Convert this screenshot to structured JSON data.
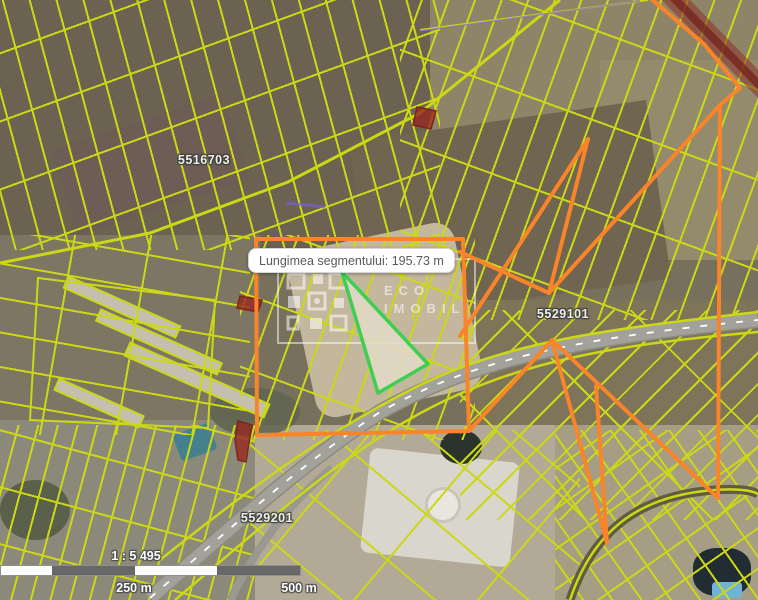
{
  "tooltip": {
    "text": "Lungimea segmentului: 195.73 m"
  },
  "parcels": {
    "labels": [
      "5516703",
      "5529101",
      "5529201"
    ]
  },
  "watermark": {
    "brand_line1": "ECO",
    "brand_line2": "IMOBIL"
  },
  "scalebar": {
    "scale_text": "1 : 5 495",
    "label_mid": "250 m",
    "label_end": "500 m"
  },
  "colors": {
    "parcel_line": "#ccd816",
    "measurement_orange": "#F98429",
    "highlight_green": "#3ECF52",
    "red_parcel": "#96352c",
    "road_red_band": "#8c2f28",
    "road_gray": "#a3a29a"
  }
}
